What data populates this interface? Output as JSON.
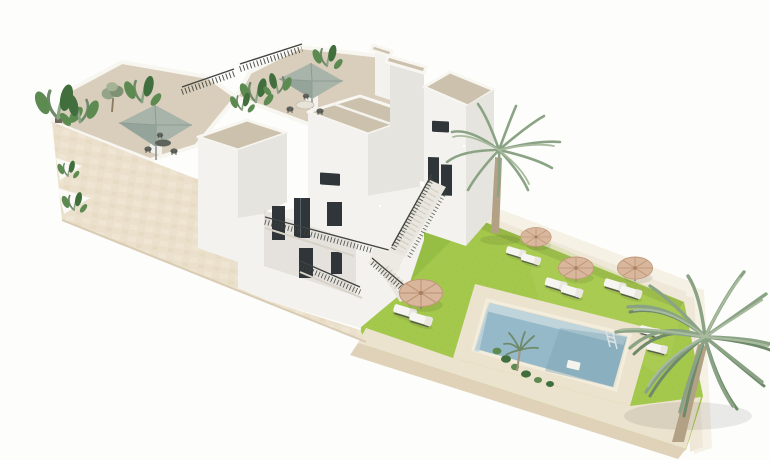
{
  "scene": {
    "description": "3D architectural rendering of a white Mediterranean-style apartment building with stepped roof terraces, sage-green roof parasols, plants, an exterior staircase leading to a walled garden with bright green lawn, a rectangular swimming pool with stone deck, four straw parasols with white sun loungers and two tall palm trees",
    "view": "isometric aerial exterior visualization",
    "objects": {
      "roof_terraces": 2,
      "roof_parasols": 2,
      "dining_sets": 2,
      "garden_parasols": 4,
      "sun_loungers": 10,
      "palm_trees_large": 2,
      "swimming_pools": 1,
      "pool_ladder": 1,
      "pool_float": 1
    }
  },
  "colors": {
    "background": "#fdfdfb",
    "stone_wall": "#ebe0cc",
    "stone_texture_light": "#f4ecdb",
    "stone_texture_dark": "#e2d4ba",
    "terrace_floor": "#d8cebb",
    "roof_panel": "#cbc1ad",
    "wall_white": "#f3f2ee",
    "wall_shaded": "#e6e4de",
    "wall_dark": "#d9d6cf",
    "parapet": "#f8f6f1",
    "window_glass": "#2f3538",
    "railing": "#42453f",
    "canopy_sage": "#a8b3a9",
    "canopy_sage_dark": "#95a49a",
    "lawn": "#a4c84c",
    "lawn_light": "#b7d563",
    "lawn_shade": "#88b23c",
    "deck": "#ece3cf",
    "deck_face": "#dfd2b8",
    "pool_water": "#95b9c9",
    "pool_water_deep": "#7aa2b5",
    "pool_shelf": "#c0d4db",
    "coping": "#f3edde",
    "straw": "#d9b79d",
    "straw_line": "#c2997b",
    "lounger": "#f6f5f1",
    "lounger_frame": "#585b52",
    "palm_green": "#8ba385",
    "palm_green_dark": "#6f8a6a",
    "palm_green_light": "#a9bb9e",
    "trunk": "#b3a186",
    "plant_green": "#5c8a50",
    "plant_green_dark": "#416e3d",
    "wall_top": "#f6f1e5",
    "wall_inner": "#efe8d9",
    "table_dark": "#5f635b"
  }
}
